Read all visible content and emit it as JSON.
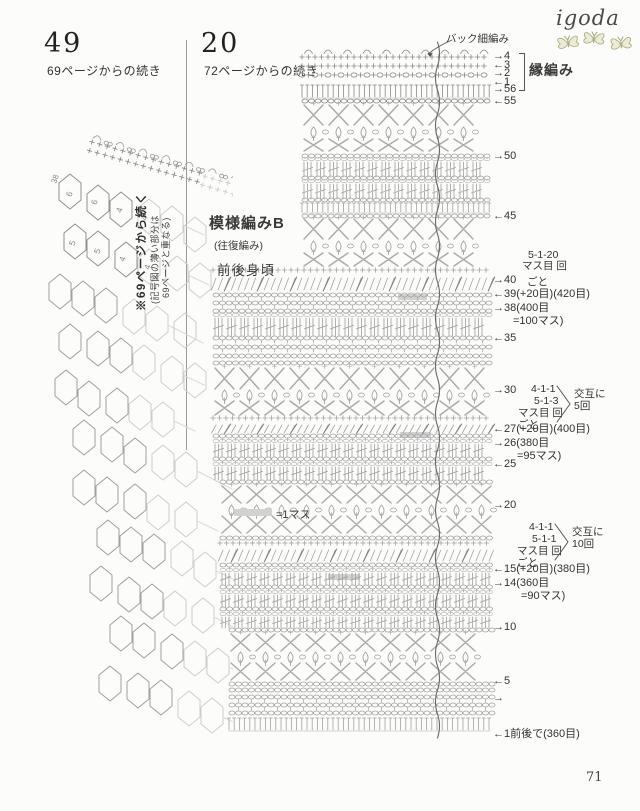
{
  "page": {
    "number": "71",
    "brand": "igoda"
  },
  "colors": {
    "ink": "#3a3a3a",
    "chart_gray": "#a3a3a3",
    "chart_dark": "#8a8a8a",
    "mesh_gray": "#a0a0a0",
    "mesh_light": "#cdcdcd",
    "olive": "#b9ba8e",
    "highlight_gray": "#d2d2d2"
  },
  "left_section": {
    "item_number": "49",
    "continued_from": "69ページからの続き",
    "vertical_note": "※69ページから続く",
    "vertical_note_sub1": "(記号図の薄い部分は",
    "vertical_note_sub2": "69ページと重なる)",
    "corner_number": "38",
    "cell_numbers": [
      [
        "6",
        "6",
        "4",
        "4"
      ],
      [
        "5",
        "5",
        "4",
        "4"
      ]
    ]
  },
  "right_section": {
    "item_number": "20",
    "continued_from": "72ページからの続き",
    "back_sc_label": "バック細編み",
    "edge_label": "縁編み",
    "pattern_label": "模様編みB",
    "pattern_sub_label": "(往復編み)",
    "body_label": "前後身頃",
    "legend_label": "=1マス",
    "row_markers": [
      {
        "y": 51,
        "a": "→",
        "t": "4"
      },
      {
        "y": 60,
        "a": "←",
        "t": "3"
      },
      {
        "y": 68,
        "a": "→",
        "t": "2"
      },
      {
        "y": 77,
        "a": "←",
        "t": "1"
      },
      {
        "y": 84,
        "a": "→",
        "t": "56"
      },
      {
        "y": 96,
        "a": "←",
        "t": "55"
      },
      {
        "y": 151,
        "a": "→",
        "t": "50"
      },
      {
        "y": 211,
        "a": "←",
        "t": "45"
      },
      {
        "y": 275,
        "a": "→",
        "t": "40"
      },
      {
        "y": 289,
        "a": "←",
        "t": "39(+20目)(420目)"
      },
      {
        "y": 303,
        "a": "→",
        "t": "38(400目"
      },
      {
        "y": 316,
        "a": "",
        "t": "=100マス)",
        "x": 512
      },
      {
        "y": 333,
        "a": "←",
        "t": "35"
      },
      {
        "y": 385,
        "a": "→",
        "t": "30"
      },
      {
        "y": 424,
        "a": "←",
        "t": "27(+20目)(400目)"
      },
      {
        "y": 438,
        "a": "→",
        "t": "26(380目"
      },
      {
        "y": 451,
        "a": "",
        "t": "=95マス)",
        "x": 516
      },
      {
        "y": 459,
        "a": "←",
        "t": "25"
      },
      {
        "y": 500,
        "a": "→",
        "t": "20"
      },
      {
        "y": 564,
        "a": "←",
        "t": "15(+20目)(380目)"
      },
      {
        "y": 578,
        "a": "→",
        "t": "14(360目"
      },
      {
        "y": 591,
        "a": "",
        "t": "=90マス)",
        "x": 520
      },
      {
        "y": 622,
        "a": "→",
        "t": "10"
      },
      {
        "y": 676,
        "a": "←",
        "t": "5"
      },
      {
        "y": 693,
        "a": "→",
        "t": ""
      },
      {
        "y": 729,
        "a": "←",
        "t": "1前後で(360目)"
      }
    ],
    "notes": [
      {
        "x": 528,
        "y": 250,
        "t": "5-1-20"
      },
      {
        "x": 522,
        "y": 261,
        "t": "マス目 回"
      },
      {
        "x": 527,
        "y": 277,
        "t": "ごと"
      },
      {
        "x": 531,
        "y": 384,
        "t": "4-1-1"
      },
      {
        "x": 534,
        "y": 396,
        "t": "5-1-3"
      },
      {
        "x": 518,
        "y": 408,
        "t": "マス目 回"
      },
      {
        "x": 518,
        "y": 420,
        "t": "ごと"
      },
      {
        "x": 574,
        "y": 389,
        "t": "交互に"
      },
      {
        "x": 574,
        "y": 401,
        "t": "5回"
      },
      {
        "x": 529,
        "y": 522,
        "t": "4-1-1"
      },
      {
        "x": 532,
        "y": 534,
        "t": "5-1-1"
      },
      {
        "x": 517,
        "y": 546,
        "t": "マス目 回"
      },
      {
        "x": 517,
        "y": 558,
        "t": "ごと"
      },
      {
        "x": 572,
        "y": 527,
        "t": "交互に"
      },
      {
        "x": 572,
        "y": 539,
        "t": "10回"
      }
    ],
    "braces": [
      {
        "x": 556,
        "y": 385
      },
      {
        "x": 554,
        "y": 523
      }
    ]
  },
  "chart_data": {
    "type": "crochet-symbol-chart",
    "center_line_x": 437,
    "extents": [
      [
        45,
        268,
        302,
        490
      ],
      [
        268,
        475,
        213,
        491
      ],
      [
        475,
        626,
        220,
        491
      ],
      [
        626,
        745,
        229,
        490
      ]
    ],
    "highlights": [
      [
        398,
        294,
        29,
        6
      ],
      [
        400,
        432,
        31,
        6
      ],
      [
        328,
        574,
        32,
        6
      ]
    ],
    "legend_swatch": [
      234,
      509,
      38,
      7
    ],
    "bands": [
      [
        57,
        "picot"
      ],
      [
        66,
        "plus"
      ],
      [
        75,
        "oval"
      ],
      [
        85,
        "tbar12"
      ],
      [
        99,
        "chain"
      ],
      [
        105,
        "x20"
      ],
      [
        127,
        "diam"
      ],
      [
        139,
        "x12"
      ],
      [
        154,
        "chain"
      ],
      [
        159,
        "bars15"
      ],
      [
        176,
        "chain"
      ],
      [
        181,
        "bars15"
      ],
      [
        198,
        "chain"
      ],
      [
        203,
        "tbar9"
      ],
      [
        214,
        "chain"
      ],
      [
        219,
        "x20"
      ],
      [
        241,
        "diam"
      ],
      [
        253,
        "x13"
      ],
      [
        270,
        "plus"
      ],
      [
        278,
        "slant12"
      ],
      [
        293,
        "ovalchain"
      ],
      [
        301,
        "ovalchain"
      ],
      [
        309,
        "chain"
      ],
      [
        315,
        "bars18"
      ],
      [
        336,
        "ovalchain"
      ],
      [
        345,
        "ovalchain"
      ],
      [
        354,
        "chain"
      ],
      [
        361,
        "chain"
      ],
      [
        368,
        "x21"
      ],
      [
        390,
        "diam"
      ],
      [
        401,
        "x14"
      ],
      [
        418,
        "plus"
      ],
      [
        425,
        "slant8"
      ],
      [
        434,
        "ovalchain"
      ],
      [
        441,
        "bars13"
      ],
      [
        457,
        "ovalchain"
      ],
      [
        464,
        "bars13"
      ],
      [
        480,
        "chain"
      ],
      [
        486,
        "x17"
      ],
      [
        505,
        "diam"
      ],
      [
        516,
        "x17"
      ],
      [
        536,
        "chain"
      ],
      [
        543,
        "plus"
      ],
      [
        550,
        "slant11"
      ],
      [
        563,
        "ovalchain"
      ],
      [
        570,
        "bars12"
      ],
      [
        585,
        "ovalchain"
      ],
      [
        592,
        "bars12"
      ],
      [
        607,
        "ovalchain"
      ],
      [
        614,
        "bars11"
      ],
      [
        628,
        "chain"
      ],
      [
        634,
        "x17"
      ],
      [
        652,
        "diam"
      ],
      [
        663,
        "x17"
      ],
      [
        682,
        "chain"
      ],
      [
        688,
        "chain"
      ],
      [
        695,
        "ovalchain"
      ],
      [
        703,
        "ovalchain"
      ],
      [
        711,
        "chain"
      ],
      [
        718,
        "tbar12"
      ]
    ]
  }
}
